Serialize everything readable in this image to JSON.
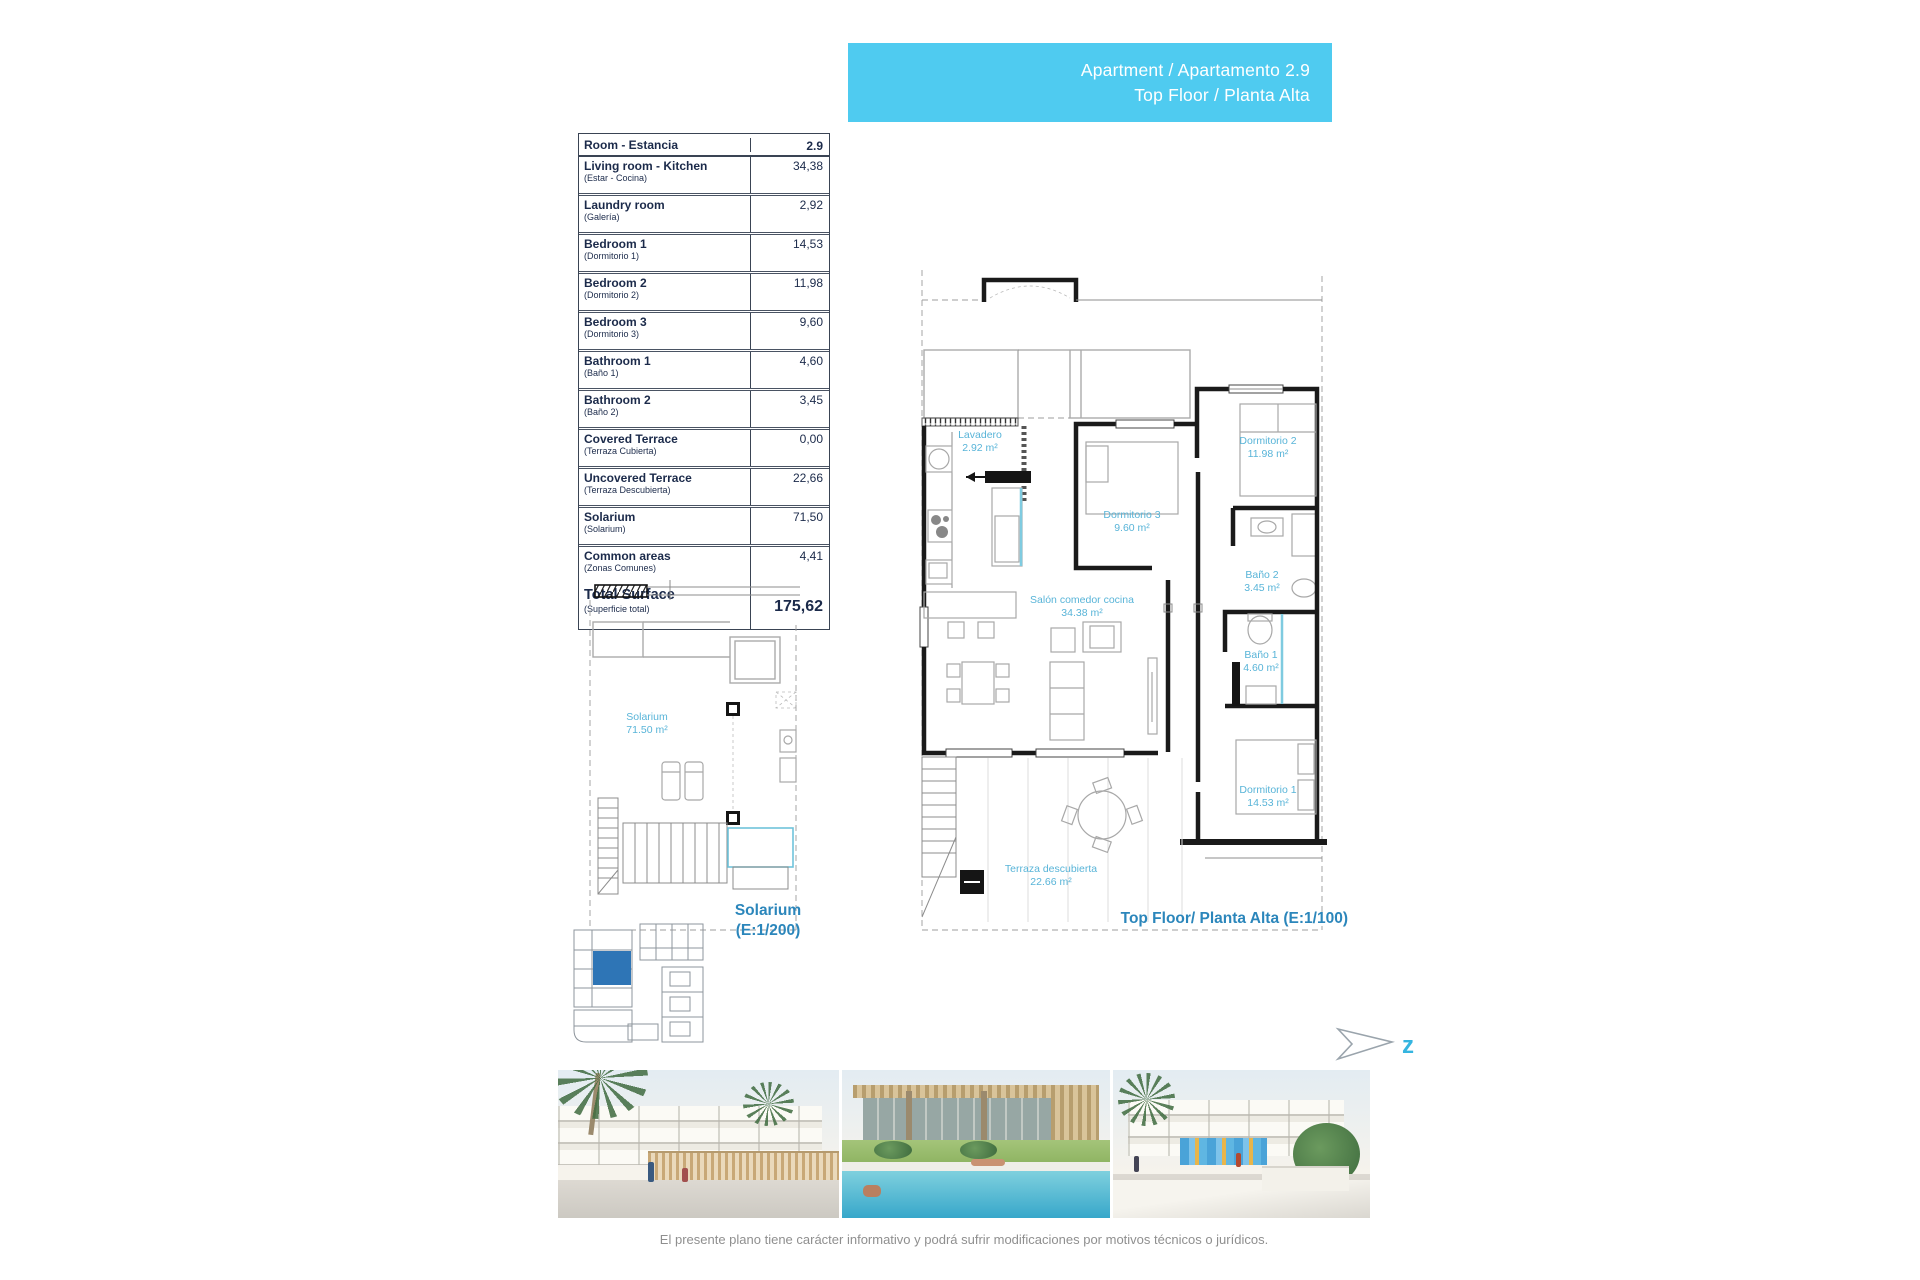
{
  "banner": {
    "line1": "Apartment / Apartamento 2.9",
    "line2": "Top Floor / Planta Alta"
  },
  "surface_table": {
    "header": {
      "name": "Room - Estancia",
      "value": "2.9"
    },
    "rows": [
      {
        "name": "Living room - Kitchen",
        "sub": "(Estar - Cocina)",
        "value": "34,38"
      },
      {
        "name": "Laundry room",
        "sub": "(Galería)",
        "value": "2,92"
      },
      {
        "name": "Bedroom 1",
        "sub": "(Dormitorio 1)",
        "value": "14,53"
      },
      {
        "name": "Bedroom 2",
        "sub": "(Dormitorio 2)",
        "value": "11,98"
      },
      {
        "name": "Bedroom 3",
        "sub": "(Dormitorio 3)",
        "value": "9,60"
      },
      {
        "name": "Bathroom 1",
        "sub": "(Baño 1)",
        "value": "4,60"
      },
      {
        "name": "Bathroom 2",
        "sub": "(Baño 2)",
        "value": "3,45"
      },
      {
        "name": "Covered Terrace",
        "sub": "(Terraza Cubierta)",
        "value": "0,00"
      },
      {
        "name": "Uncovered Terrace",
        "sub": "(Terraza Descubierta)",
        "value": "22,66"
      },
      {
        "name": "Solarium",
        "sub": "(Solarium)",
        "value": "71,50"
      },
      {
        "name": "Common areas",
        "sub": "(Zonas Comunes)",
        "value": "4,41"
      }
    ],
    "total": {
      "name": "Total Surface",
      "sub": "(Superficie total)",
      "value": "175,62"
    }
  },
  "main_plan": {
    "caption": "Top Floor/ Planta Alta (E:1/100)",
    "rooms": [
      {
        "label": "Lavadero",
        "area": "2.92 m²"
      },
      {
        "label": "Dormitorio 2",
        "area": "11.98 m²"
      },
      {
        "label": "Dormitorio 3",
        "area": "9.60 m²"
      },
      {
        "label": "Baño 2",
        "area": "3.45 m²"
      },
      {
        "label": "Salón comedor cocina",
        "area": "34.38 m²"
      },
      {
        "label": "Baño 1",
        "area": "4.60 m²"
      },
      {
        "label": "Dormitorio 1",
        "area": "14.53 m²"
      },
      {
        "label": "Terraza descubierta",
        "area": "22.66 m²"
      }
    ]
  },
  "solarium_plan": {
    "room_label": "Solarium",
    "room_area": "71.50 m²",
    "caption_line1": "Solarium",
    "caption_line2": "(E:1/200)"
  },
  "north": {
    "letter": "z"
  },
  "footer": {
    "disclaimer": "El presente plano tiene carácter informativo y podrá sufrir modificaciones por motivos técnicos o jurídicos."
  },
  "colors": {
    "accent_cyan": "#4FCBF0",
    "label_cyan": "#58B4D8",
    "caption_blue": "#2B86BB",
    "table_ink": "#1B2A4A",
    "keyplan_highlight": "#2E75B6"
  }
}
